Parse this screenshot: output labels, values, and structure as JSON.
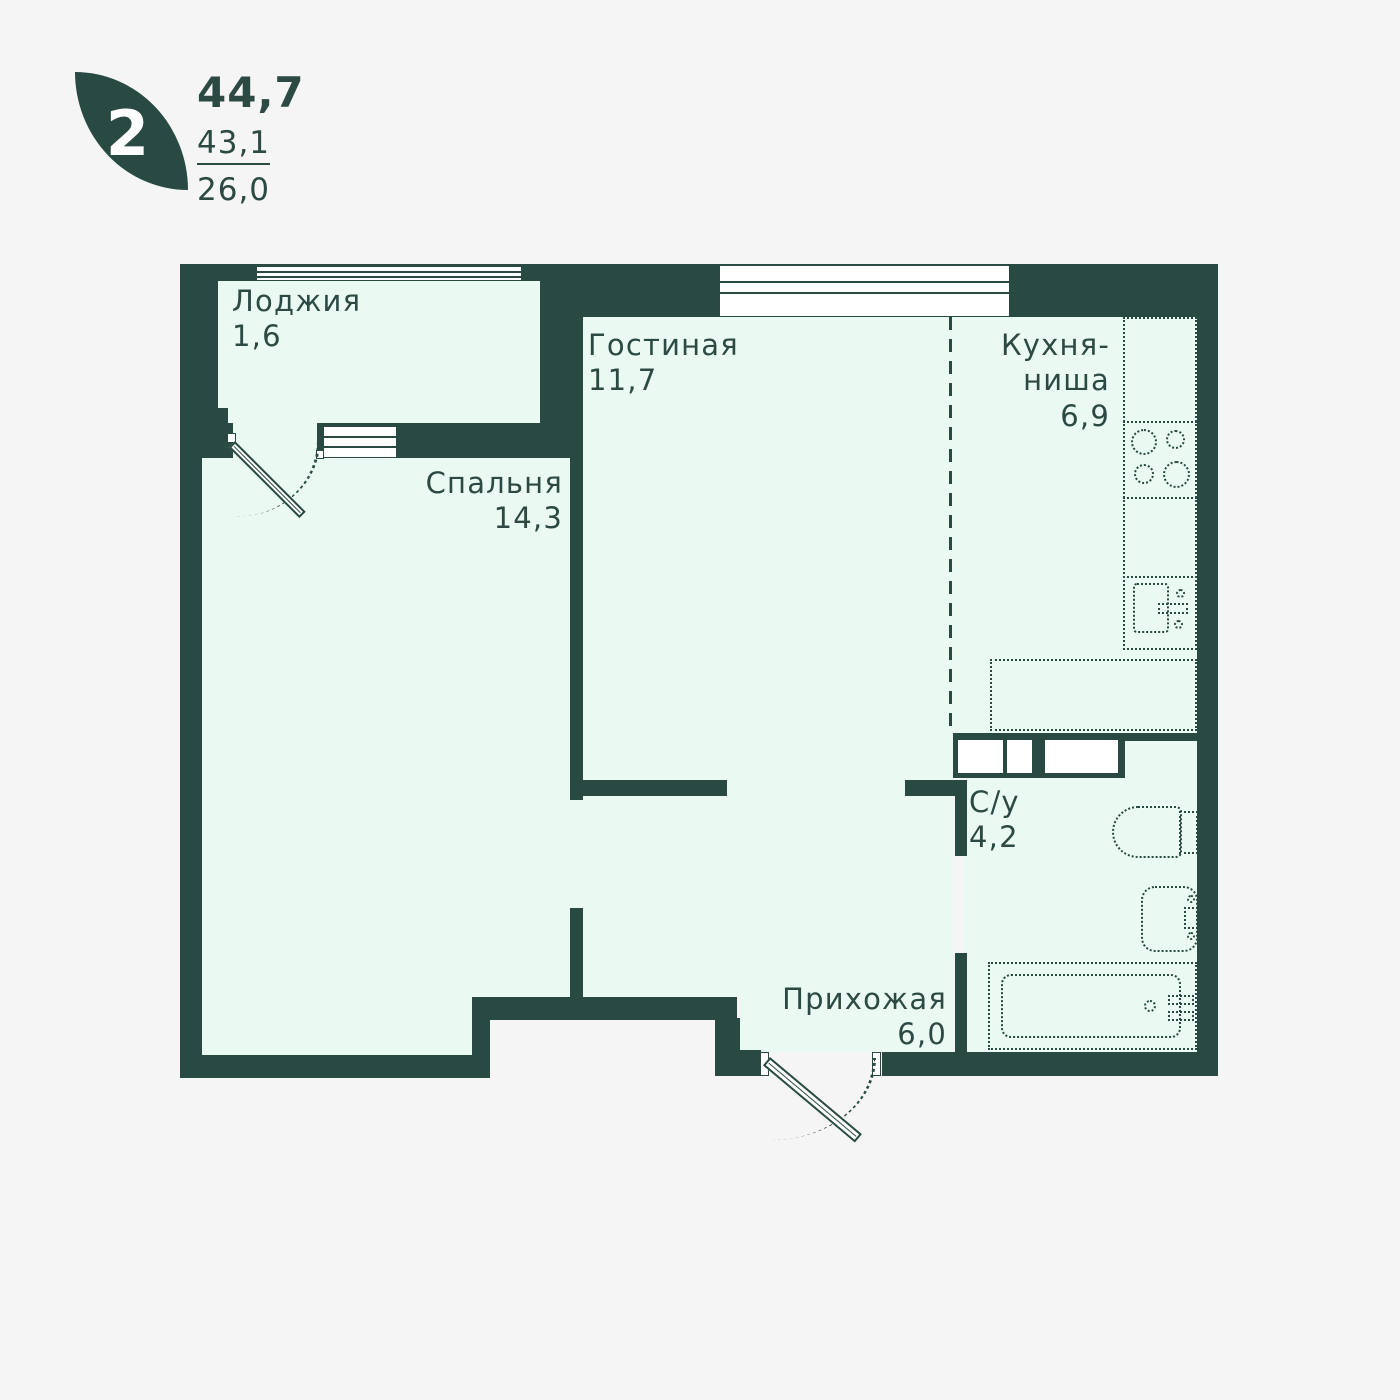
{
  "header": {
    "rooms_badge": "2",
    "area_total": "44,7",
    "area_secondary": "43,1",
    "area_tertiary": "26,0"
  },
  "rooms": {
    "loggia": {
      "name": "Лоджия",
      "area": "1,6"
    },
    "living": {
      "name": "Гостиная",
      "area": "11,7"
    },
    "kitchen": {
      "name_line1": "Кухня-",
      "name_line2": "ниша",
      "area": "6,9"
    },
    "bedroom": {
      "name": "Спальня",
      "area": "14,3"
    },
    "bathroom": {
      "name": "С/у",
      "area": "4,2"
    },
    "hallway": {
      "name": "Прихожая",
      "area": "6,0"
    }
  },
  "fixtures": [
    "balcony-door",
    "entrance-door",
    "loggia-window",
    "living-room-window",
    "loggia-bedroom-window",
    "kitchen-counter",
    "stove-burners",
    "kitchen-sink",
    "wardrobe",
    "toilet",
    "washbasin",
    "bathtub"
  ],
  "colors": {
    "wall": "#284A42",
    "floor": "#EAFAF2",
    "background": "#F4F5F4",
    "text": "#2C4A43",
    "window": "#FFFFFF"
  }
}
